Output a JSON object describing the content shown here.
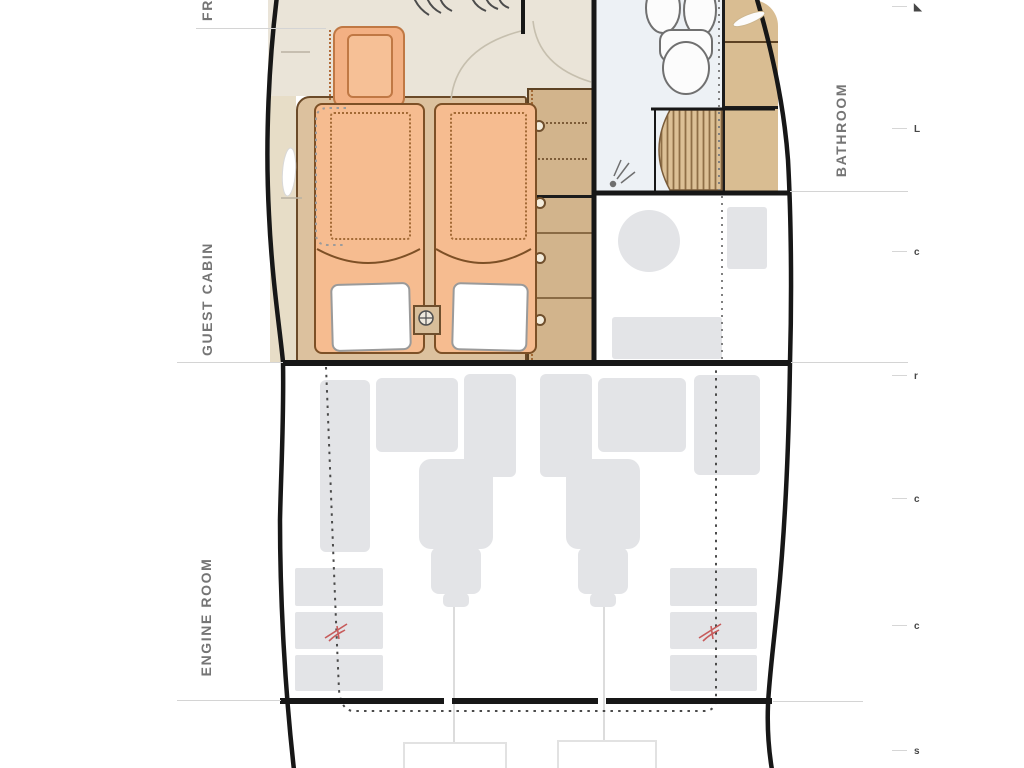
{
  "labels": {
    "bow_area_clipped": "FR",
    "guest_cabin": "GUEST CABIN",
    "engine_room": "ENGINE ROOM",
    "bathroom": "BATHROOM"
  },
  "scale_marks": [
    {
      "glyph": "◣"
    },
    {
      "glyph": "L"
    },
    {
      "glyph": "c"
    },
    {
      "glyph": "r"
    },
    {
      "glyph": "c"
    },
    {
      "glyph": "c"
    },
    {
      "glyph": "s"
    }
  ],
  "colors": {
    "hull_line": "#171717",
    "wood_tan": "#d2b48c",
    "platform_tan": "#dcc19e",
    "mattress_orange": "#f6bc90",
    "mattress_border": "#7d5026",
    "furniture_gray": "#e3e4e7",
    "bathroom_floor": "#edf1f5",
    "propeller_mark_red": "#c75b5b",
    "label_gray": "#757575"
  }
}
